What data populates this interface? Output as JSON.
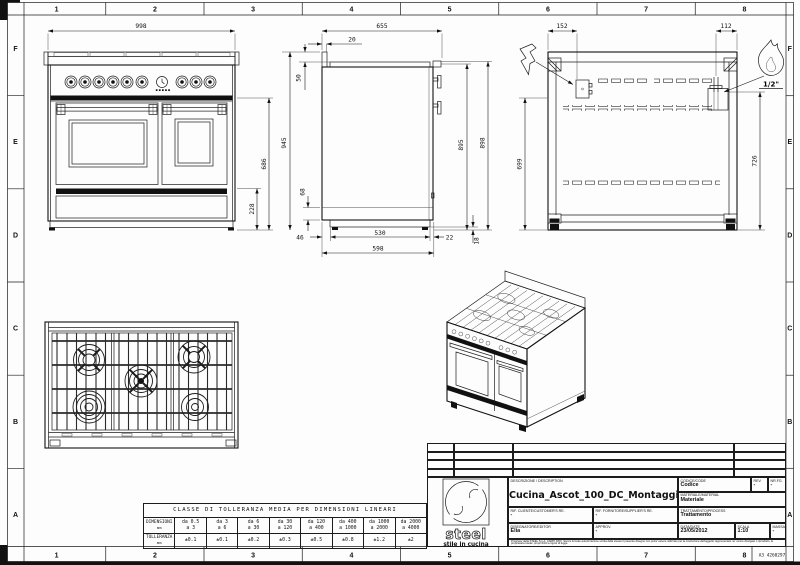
{
  "frame": {
    "columns": [
      "1",
      "2",
      "3",
      "4",
      "5",
      "6",
      "7",
      "8"
    ],
    "rows": [
      "F",
      "E",
      "D",
      "C",
      "B",
      "A"
    ],
    "sheet_code": "A3 4260297"
  },
  "views": {
    "front": {
      "dims": {
        "width": "998",
        "height": "686",
        "base_height": "228"
      }
    },
    "side": {
      "dims": {
        "depth": "655",
        "top_offset": "20",
        "splash": "50",
        "height": "945",
        "kick": "68",
        "back_inset": "46",
        "base_depth": "530",
        "front_inset": "22",
        "base_total": "598",
        "h895": "895",
        "h898": "898",
        "foot": "18"
      }
    },
    "rear": {
      "dims": {
        "electric_x": "152",
        "gas_x": "112",
        "electric_h": "699",
        "gas_h": "726"
      },
      "gas_size": "1/2\""
    }
  },
  "revision_table": {
    "rows": [
      "3",
      "2",
      "1"
    ],
    "headers": {
      "num": "NUM",
      "data": "DATA",
      "modifica": "MODIFICA",
      "esecutore": "ESECUTORE"
    }
  },
  "title_block": {
    "logo": {
      "name": "steel",
      "tagline": "stile in cucina"
    },
    "description_label": "DESCRIZIONE / DESCRIPTION",
    "description": "Cucina_Ascot_100_DC_Montaggio",
    "code_label": "CODICE/CODE",
    "code": "Codice",
    "rev_label": "REV.",
    "rev": "-",
    "nr_label": "NR.FG.",
    "nr": "-",
    "material_label": "MATERIALE/MATERIAL",
    "material": "Materiale",
    "customer_label": "RIF. CLIENTE/CUSTOMER'S RE.",
    "customer": "-",
    "supplier_label": "RIF. FORNITORE/SUPPLIER'S RE.",
    "supplier": "-",
    "process_label": "TRATTAMENTO/PROCESS",
    "process": "Trattamento",
    "editor_label": "DISEGNATORE/EDITOR",
    "editor": "Elia",
    "approv_label": "APPROV.",
    "approv": "-",
    "date_label": "DATA/DATE",
    "date": "23/05/2012",
    "scale_label": "SCALA",
    "scale": "1:10",
    "mass_label": "MASSA/MASS kg",
    "mass": "-",
    "legal": "Proprieta' della STEEL S.p.A. CARPI (MO). Senza formale autorizzazione scritta della stessa il presente disegno non potra' essere utilizzato per la costruzione dell'oggetto rappresentato ne' venire divulgato o riprodotto, la proprietaria tutela i propri diritti a rigore di legge."
  },
  "tolerance_table": {
    "title": "CLASSE DI TOLLERANZA MEDIA PER DIMENSIONI LINEARI",
    "dim_label": "DIMENSIONI",
    "dim_unit": "mm",
    "tol_label": "TOLLERANZA",
    "tol_unit": "mm",
    "ranges": [
      {
        "l1": "da 0.5",
        "l2": "a 3"
      },
      {
        "l1": "da 3",
        "l2": "a 6"
      },
      {
        "l1": "da 6",
        "l2": "a 30"
      },
      {
        "l1": "da 30",
        "l2": "a 120"
      },
      {
        "l1": "da 120",
        "l2": "a 400"
      },
      {
        "l1": "da 400",
        "l2": "a 1000"
      },
      {
        "l1": "da 1000",
        "l2": "a 2000"
      },
      {
        "l1": "da 2000",
        "l2": "a 4000"
      }
    ],
    "tolerances": [
      "±0.1",
      "±0.1",
      "±0.2",
      "±0.3",
      "±0.5",
      "±0.8",
      "±1.2",
      "±2"
    ]
  }
}
